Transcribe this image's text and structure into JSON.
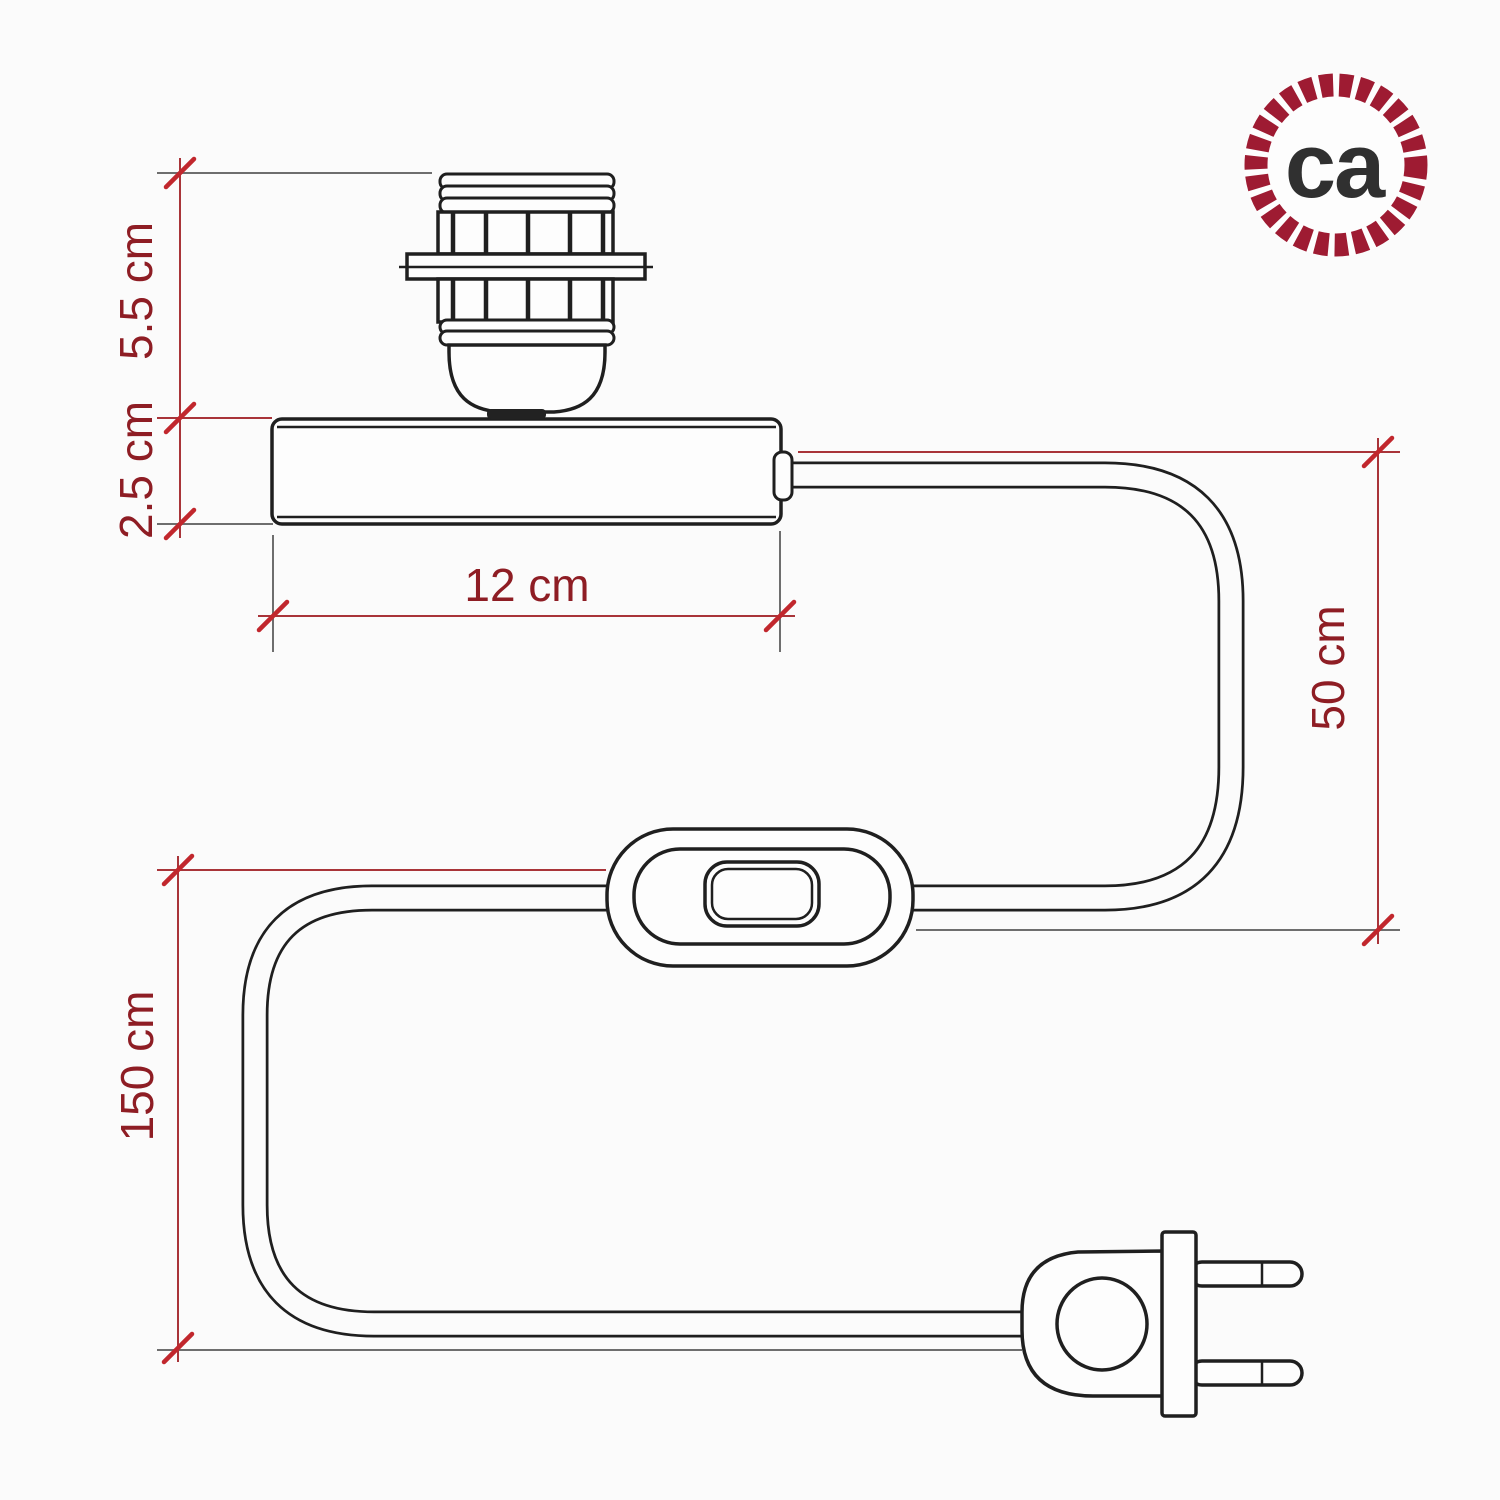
{
  "page": {
    "background": "#fbfbfb"
  },
  "logo": {
    "text": "ca",
    "ring_color": "#9e1b32",
    "text_color": "#303030"
  },
  "diagram": {
    "subject": "Table lamp base with E27 shade lamp holder, flat base, inline rocker switch and two-pin plug - dimension drawing",
    "line_color": "#1f1f1f",
    "dimension_color": "#a93439",
    "tick_color": "#c1272d",
    "label_color": "#8e1d24",
    "extension_color": "#6e6e6e",
    "labels": {
      "socket_height": "5.5 cm",
      "base_height": "2.5 cm",
      "base_width": "12 cm",
      "base_to_switch": "50 cm",
      "total_cable": "150 cm"
    }
  }
}
